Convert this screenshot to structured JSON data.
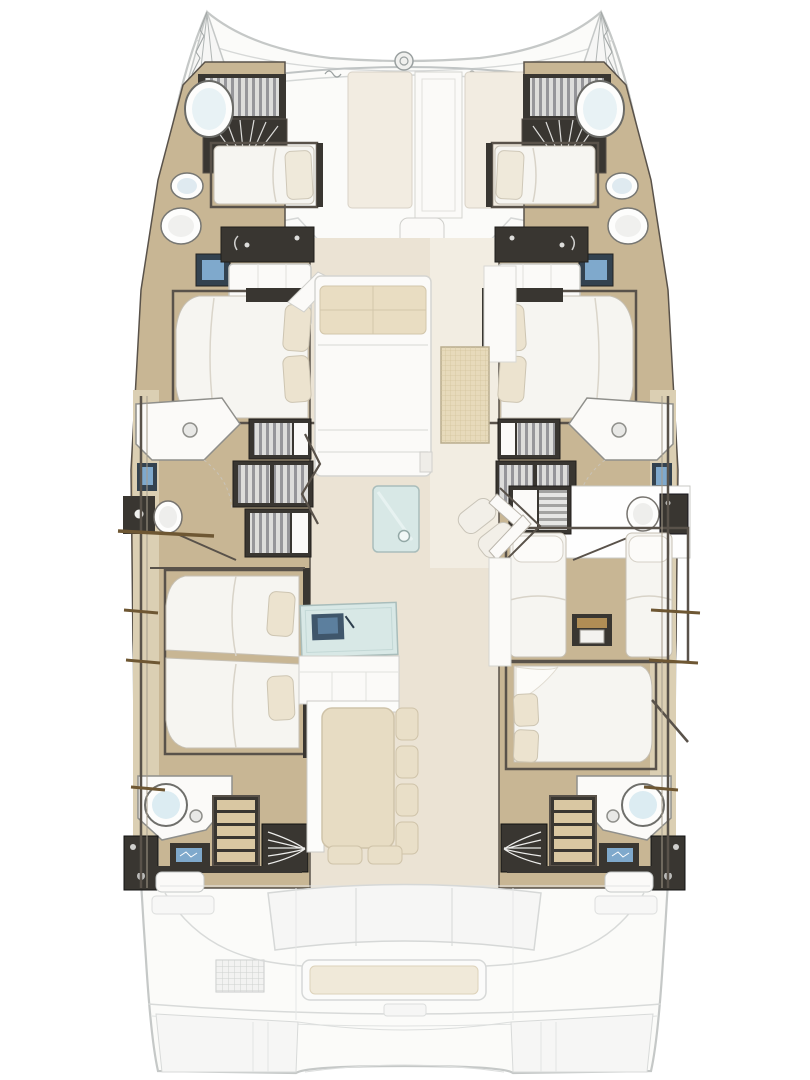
{
  "diagram": {
    "type": "yacht-deck-plan",
    "subject": "sailing catamaran interior layout, bow up, no text labels",
    "port_hull_rooms": [
      "forward-cabin",
      "forward-head",
      "mid-cabin",
      "companionway-stairs",
      "mid-head",
      "aft-double-cabin",
      "aft-head"
    ],
    "starboard_hull_rooms": [
      "forward-cabin",
      "forward-head",
      "mid-cabin",
      "companionway-stairs",
      "mid-head",
      "twin-guest-cabin",
      "aft-double-cabin",
      "aft-head"
    ],
    "centerline_areas": [
      "bow-anchor-lockers",
      "foredeck-sunpads",
      "windlass",
      "salon-settee",
      "woven-mat",
      "glass-coffee-table",
      "lounge-chair",
      "galley-sink-counter",
      "dining-table",
      "aft-cockpit-bench",
      "stern-swim-platforms"
    ]
  },
  "palette": {
    "deck_white": "#fbfbf9",
    "hull_outline": "#c5c8c7",
    "faded_line": "#d6d8d7",
    "faded_fill": "#f6f6f5",
    "wood": "#c8b694",
    "wood_light": "#dbcfb3",
    "floor": "#ebe3d4",
    "floor_light": "#f2ede2",
    "dark": "#393631",
    "frame": "#59524a",
    "white": "#fbfaf8",
    "cream": "#e9ddc2",
    "mattress": "#f6f5f1",
    "glass": "#d8e8e6",
    "sink_blue": "#7fa9cc",
    "navy": "#33424f",
    "mat": "#e7dabb",
    "step_wood": "#d9c7a2",
    "tick_brown": "#6e5733"
  }
}
